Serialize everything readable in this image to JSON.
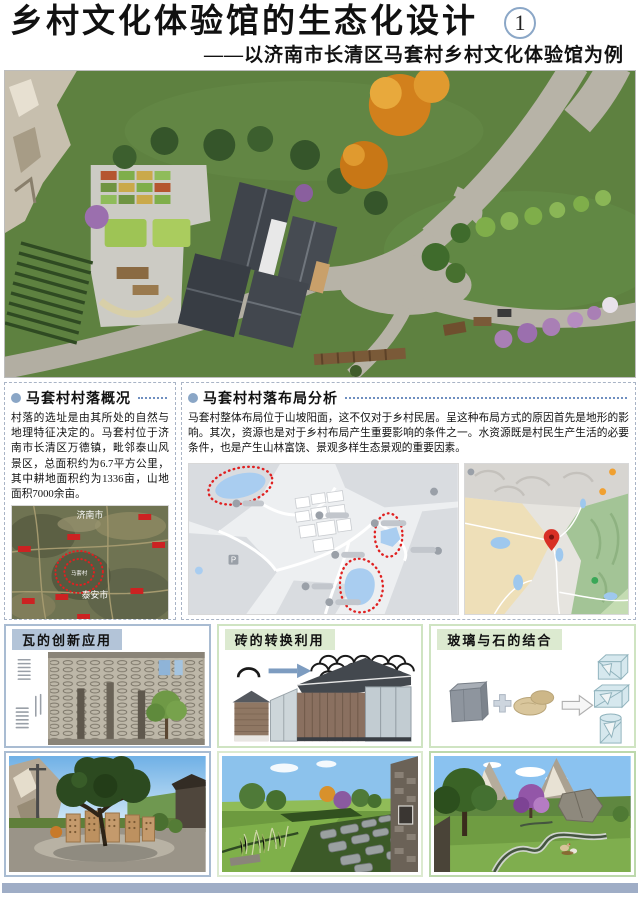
{
  "header": {
    "title": "乡村文化体验馆的生态化设计",
    "page_number": "1",
    "subtitle": "——以济南市长清区马套村乡村文化体验馆为例"
  },
  "sections": {
    "overview": {
      "title": "马套村村落概况",
      "body": "村落的选址是由其所处的自然与地理特征决定的。马套村位于济南市长清区万德镇，毗邻泰山风景区，总面积约为6.7平方公里，其中耕地面积约为1336亩，山地面积7000余亩。",
      "map_labels": {
        "city_top": "济南市",
        "city_bottom": "泰安市",
        "village": "马套村"
      }
    },
    "layout": {
      "title": "马套村村落布局分析",
      "body": "马套村整体布局位于山坡阳面，这不仅对于乡村民居。呈这种布局方式的原因首先是地形的影响。其次，资源也是对于乡村布局产生重要影响的条件之一。水资源既是村民生产生活的必要条件，也是产生山林富饶、景观多样生态景观的重要因素。",
      "map_markers": {
        "parking": "P"
      }
    }
  },
  "materials": {
    "tile": {
      "title": "瓦的创新应用"
    },
    "brick": {
      "title": "砖的转换利用"
    },
    "glass": {
      "title": "玻璃与石的结合"
    }
  },
  "colors": {
    "footer_bar": "#9fadc6",
    "badge_ring": "#8ba7c7",
    "bullet": "#8aa6c6",
    "leader_dots": "#6f8fc0",
    "red_marker": "#e02020",
    "tile_header_bg": "#b3c4d8",
    "green_header_bg": "#dcead0"
  }
}
